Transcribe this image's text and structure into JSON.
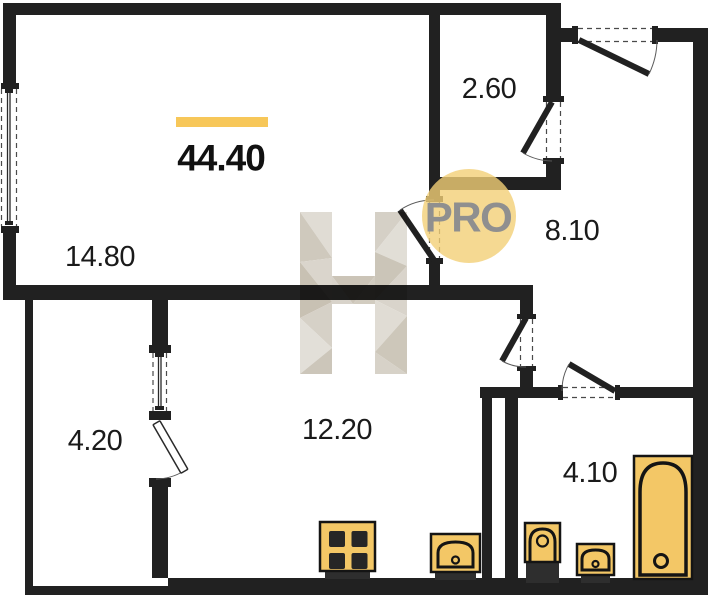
{
  "plan": {
    "type": "apartment-floor-plan",
    "total_area_label": "44.40",
    "badge_label": "PRO",
    "watermark_letter": "H",
    "rooms": [
      {
        "id": "living-room",
        "area_label": "14.80"
      },
      {
        "id": "closet",
        "area_label": "2.60"
      },
      {
        "id": "hallway",
        "area_label": "8.10"
      },
      {
        "id": "balcony",
        "area_label": "4.20"
      },
      {
        "id": "kitchen",
        "area_label": "12.20"
      },
      {
        "id": "bathroom",
        "area_label": "4.10"
      }
    ],
    "fixtures": [
      "stove",
      "kitchen-sink",
      "toilet",
      "bathroom-sink",
      "bathtub"
    ],
    "colors": {
      "wall": "#212121",
      "fixture_yellow": "#F3C766",
      "accent_bar": "#F7C759",
      "badge_fill": "#F3CF77",
      "badge_text": "#8F8F8F",
      "watermark_beige": "#D6D1C7"
    }
  }
}
